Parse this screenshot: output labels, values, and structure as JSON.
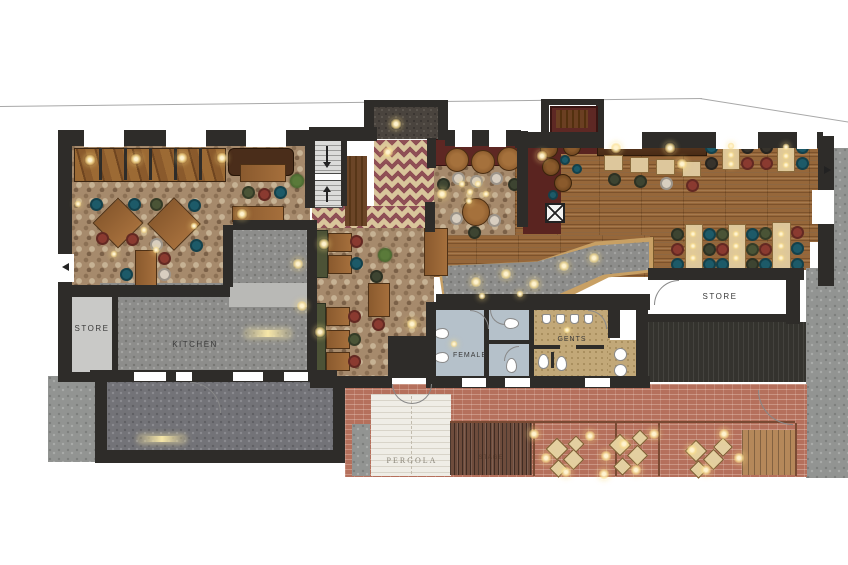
{
  "drawing": {
    "type": "architectural-floor-plan",
    "subject": "restaurant-pub ground floor plan with outdoor terrace",
    "labels": {
      "store_left": "STORE",
      "kitchen": "KITCHEN",
      "female": "FEMALE",
      "gents": "GENTS",
      "store_right": "STORE",
      "pergola": "PERGOLA",
      "stage": "STAGE"
    },
    "palette": {
      "wall": "#2e2c29",
      "cobble_floor": "#a68a6c",
      "wood_floor": "#96673a",
      "kitchen_floor": "#8d8d8b",
      "yard_floor": "#737378",
      "pavement": "#929492",
      "brick_terrace": "#b5705c",
      "rug_cream": "#d9c59b",
      "rug_maroon": "#8f4f55",
      "female_room": "#b5c1ca",
      "gents_room": "#c2a878",
      "store_room": "#c9c9c7",
      "booth_dark_red": "#5e2723",
      "bench_green": "#4c5236",
      "chair_teal": "#1d5a68",
      "chair_red": "#8a3a30",
      "chair_green": "#4a5436",
      "chair_cream": "#d8cec0",
      "fairy_light": "#f7e7a8"
    }
  }
}
